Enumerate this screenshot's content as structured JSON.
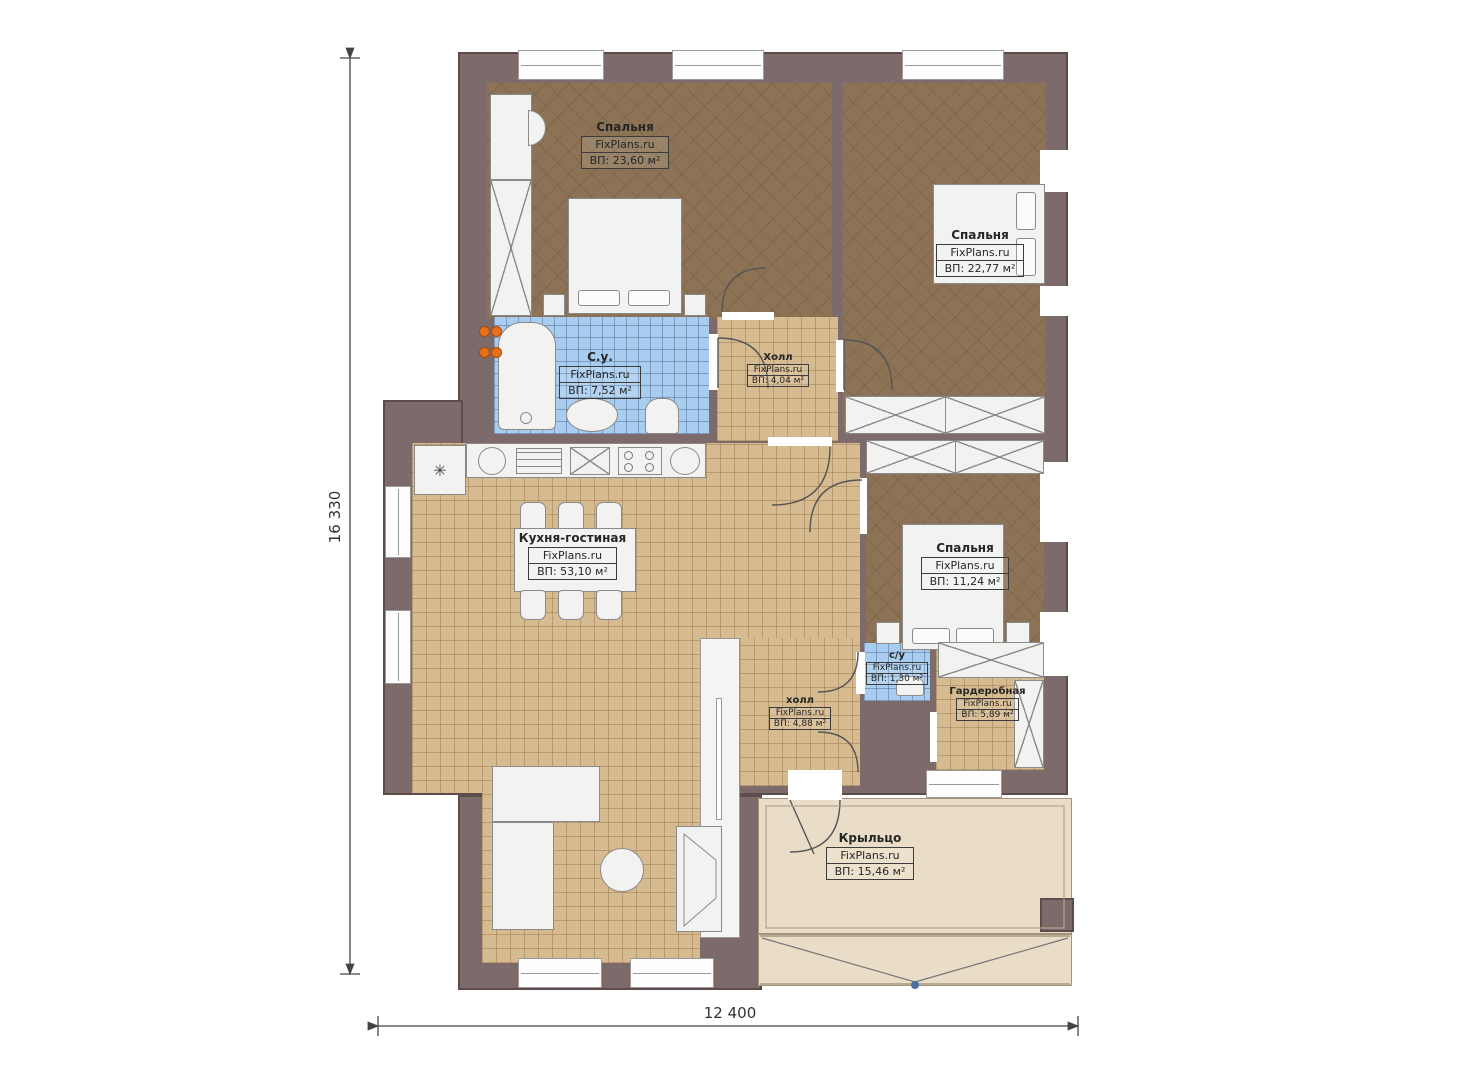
{
  "watermark": "FixPlans.ru",
  "dimensions": {
    "height": "16 330",
    "width": "12 400"
  },
  "rooms": [
    {
      "key": "bedroom1",
      "name": "Спальня",
      "area": "ВП: 23,60 м²"
    },
    {
      "key": "bedroom2",
      "name": "Спальня",
      "area": "ВП: 22,77 м²"
    },
    {
      "key": "bathroom",
      "name": "С.у.",
      "area": "ВП: 7,52 м²"
    },
    {
      "key": "hall",
      "name": "Холл",
      "area": "ВП: 4,04 м²"
    },
    {
      "key": "kitchen_living",
      "name": "Кухня-гостиная",
      "area": "ВП: 53,10 м²"
    },
    {
      "key": "bedroom3",
      "name": "Спальня",
      "area": "ВП: 11,24 м²"
    },
    {
      "key": "wc",
      "name": "с/у",
      "area": "ВП: 1,30 м²"
    },
    {
      "key": "wardrobe",
      "name": "Гардеробная",
      "area": "ВП: 5,89 м²"
    },
    {
      "key": "hall2",
      "name": "холл",
      "area": "ВП: 4,88 м²"
    },
    {
      "key": "porch",
      "name": "Крыльцо",
      "area": "ВП: 15,46 м²"
    }
  ],
  "symbols": {
    "fridge": "✳"
  },
  "colors": {
    "wall": "#7d6b6b",
    "wall_outline": "#5c4c4c",
    "floor_wood": "#8d7355",
    "floor_tile": "#d6ba90",
    "floor_bath": "#a9cdf0",
    "floor_porch": "#e9ddc7",
    "boiler_dots": "#e8701a",
    "step_marker": "#4a6fa5"
  }
}
